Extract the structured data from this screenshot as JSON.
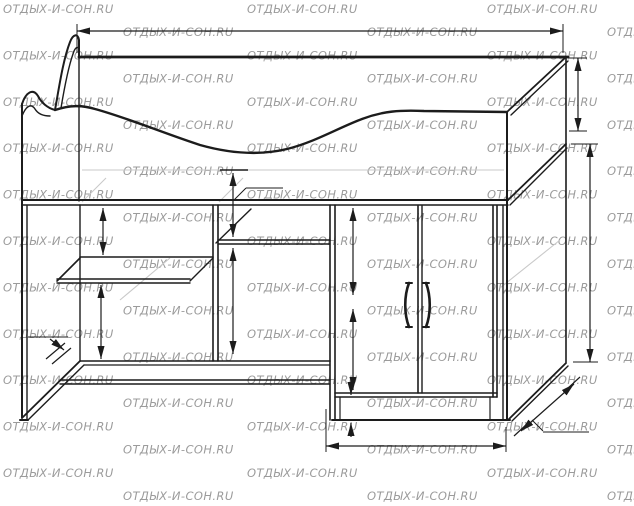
{
  "watermark": {
    "text": "ОТДЫХ-И-СОН.RU"
  },
  "colors": {
    "background": "#ffffff",
    "line": "#1c1c1c",
    "faint": "#c9c9c9",
    "watermark": "#9b9b9b",
    "dim_text": "#141414"
  },
  "dimensions": {
    "overall_width": "1632",
    "headboard_height": "280",
    "side_height": "704",
    "niche_top_gap": "210",
    "left_opening_height": "420",
    "left_niche_height": "210",
    "niche_depth": "300",
    "middle_opening_height": "420",
    "door_section_upper": "290",
    "door_section_lower": "290",
    "plinth_height": "70",
    "cabinet_width": "600",
    "overall_depth": "732"
  }
}
